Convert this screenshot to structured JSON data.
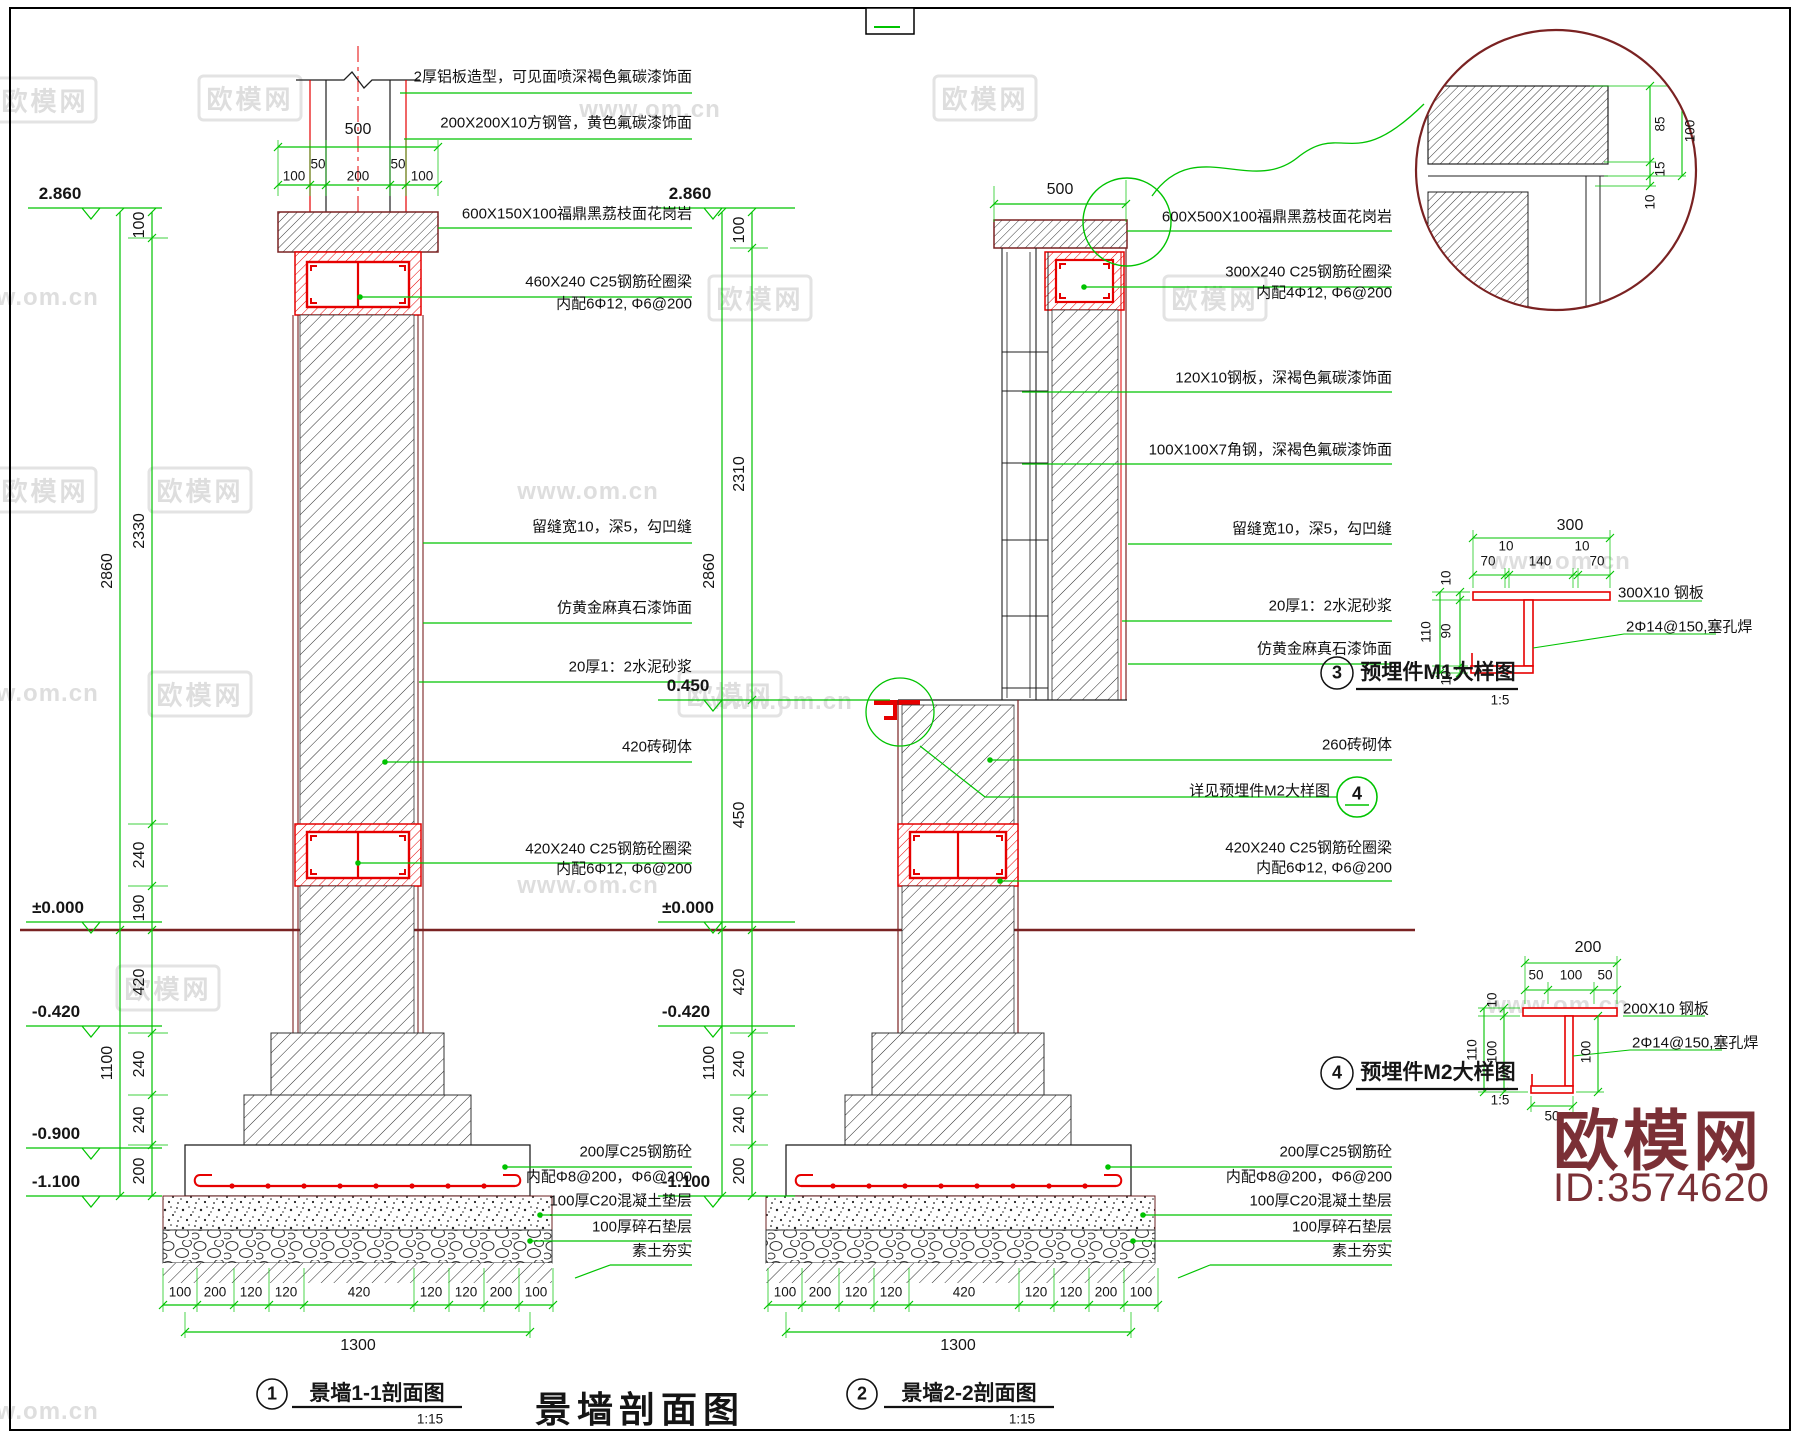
{
  "wm": {
    "logo": "欧模网",
    "url": "www.om.cn"
  },
  "s1": {
    "levels": [
      "2.860",
      "±0.000",
      "-0.420",
      "-0.900",
      "-1.100"
    ],
    "vd": [
      "100",
      "2330",
      "2860",
      "240",
      "190",
      "420",
      "240",
      "240",
      "200",
      "1100"
    ],
    "td": [
      "500",
      "100",
      "50",
      "200",
      "50",
      "100"
    ],
    "bd": [
      "100",
      "200",
      "120",
      "120",
      "420",
      "120",
      "120",
      "200",
      "100"
    ],
    "bt": "1300",
    "ann": [
      "2厚铝板造型，可见面喷深褐色氟碳漆饰面",
      "200X200X10方钢管，黄色氟碳漆饰面",
      "600X150X100福鼎黑荔枝面花岗岩",
      "460X240 C25钢筋砼圈梁",
      "内配6Φ12, Φ6@200",
      "留缝宽10，深5，勾凹缝",
      "仿黄金麻真石漆饰面",
      "20厚1：2水泥砂浆",
      "420砖砌体",
      "420X240 C25钢筋砼圈梁",
      "内配6Φ12, Φ6@200",
      "200厚C25钢筋砼",
      "内配Φ8@200，Φ6@200",
      "100厚C20混凝土垫层",
      "100厚碎石垫层",
      "素土夯实"
    ],
    "title": {
      "num": "1",
      "text": "景墙1-1剖面图",
      "scale": "1:15"
    }
  },
  "s2": {
    "levels": [
      "2.860",
      "0.450",
      "±0.000",
      "-0.420",
      "-1.100"
    ],
    "vd": [
      "100",
      "2310",
      "2860",
      "450",
      "420",
      "240",
      "240",
      "200",
      "1100"
    ],
    "td": [
      "500"
    ],
    "bd": [
      "100",
      "200",
      "120",
      "120",
      "420",
      "120",
      "120",
      "200",
      "100"
    ],
    "bt": "1300",
    "ann": [
      "600X500X100福鼎黑荔枝面花岗岩",
      "300X240 C25钢筋砼圈梁",
      "内配4Φ12, Φ6@200",
      "120X10钢板，深褐色氟碳漆饰面",
      "100X100X7角钢，深褐色氟碳漆饰面",
      "留缝宽10，深5，勾凹缝",
      "20厚1：2水泥砂浆",
      "仿黄金麻真石漆饰面",
      "260砖砌体",
      "详见预埋件M2大样图",
      "420X240 C25钢筋砼圈梁",
      "内配6Φ12, Φ6@200",
      "200厚C25钢筋砼",
      "内配Φ8@200，Φ6@200",
      "100厚C20混凝土垫层",
      "100厚碎石垫层",
      "素土夯实"
    ],
    "bubble": "4",
    "title": {
      "num": "2",
      "text": "景墙2-2剖面图",
      "scale": "1:15"
    }
  },
  "dc": {
    "d": [
      "85",
      "100",
      "15",
      "10"
    ]
  },
  "m1": {
    "top": [
      "300",
      "70",
      "10",
      "140",
      "10",
      "70"
    ],
    "left": [
      "10",
      "90",
      "10",
      "110"
    ],
    "plate": "300X10 钢板",
    "weld": "2Φ14@150,塞孔焊",
    "title": {
      "num": "3",
      "text": "预埋件M1大样图",
      "scale": "1:5"
    }
  },
  "m2": {
    "top": [
      "200",
      "50",
      "100",
      "50"
    ],
    "left": [
      "10",
      "100",
      "110"
    ],
    "right": "100",
    "bottom": "50",
    "plate": "200X10 钢板",
    "weld": "2Φ14@150,塞孔焊",
    "title": {
      "num": "4",
      "text": "预埋件M2大样图",
      "scale": "1:5"
    }
  },
  "main_title": "景墙剖面图",
  "logo": {
    "name": "欧模网",
    "id": "ID:3574620"
  }
}
